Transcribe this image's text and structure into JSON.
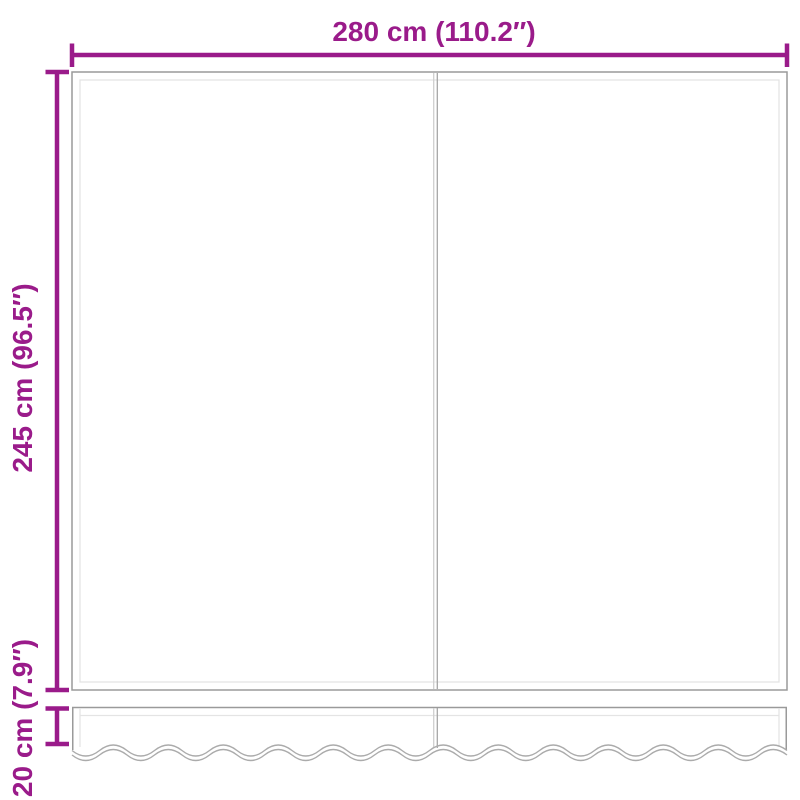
{
  "diagram": {
    "type": "product-dimension-diagram",
    "subject": "awning-replacement-fabric-with-valance",
    "labels": {
      "width": "280 cm (110.2″)",
      "height": "245 cm (96.5″)",
      "valance_height": "20 cm (7.9″)"
    },
    "colors": {
      "dimension_accent": "#9A1B8A",
      "panel_outline": "#9A9A9A",
      "panel_inner_line": "#E4E4E4",
      "wavy_edge": "#ABABAB",
      "background": "#FFFFFF"
    }
  }
}
